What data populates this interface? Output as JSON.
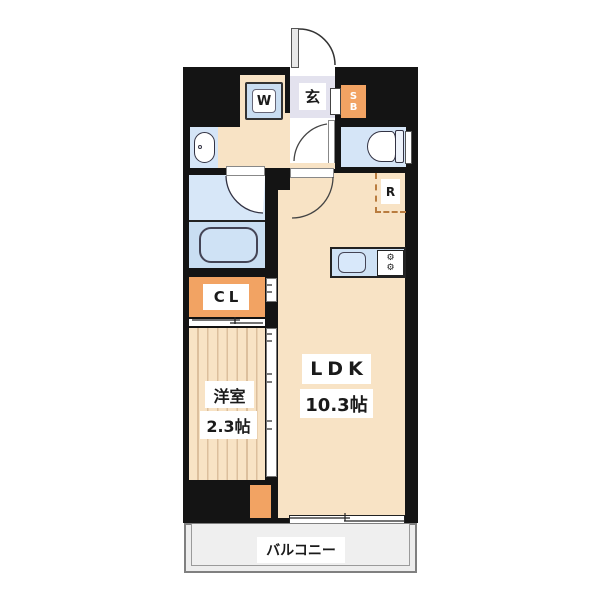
{
  "rooms": {
    "ldk": {
      "label": "LDK",
      "size": "10.3帖"
    },
    "western_room": {
      "label": "洋室",
      "size": "2.3帖"
    },
    "balcony": {
      "label": "バルコニー"
    },
    "entrance": {
      "label": "玄"
    },
    "closet": {
      "label": "CL"
    },
    "shoe_box": {
      "line1": "S",
      "line2": "B"
    },
    "washing_machine": {
      "label": "W"
    },
    "refrigerator": {
      "label": "R"
    }
  },
  "icons": {
    "stove_burner": "⚙"
  },
  "colors": {
    "wall": "#141414",
    "floor": "#f8e3c5",
    "fixture-blue": "#d5e5f7",
    "tub-zone": "#c9def2",
    "genkan": "#e3e2ee",
    "accent-orange": "#f2a363",
    "stripe": "#dcbf9d",
    "balcony-bg": "#ededed",
    "dash-orange": "#b97c3f"
  }
}
